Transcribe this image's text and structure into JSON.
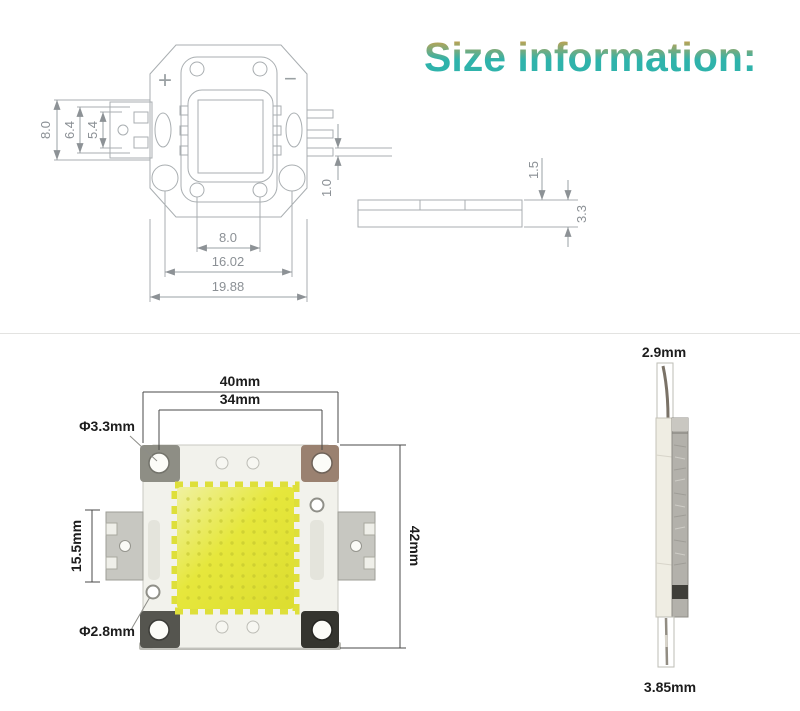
{
  "title": "Size information:",
  "top_drawing": {
    "polarity_plus": "+",
    "polarity_minus": "−",
    "dim_left_outer": "8.0",
    "dim_left_mid": "6.4",
    "dim_left_inner": "5.4",
    "dim_pin": "1.0",
    "dim_bottom_inner": "8.0",
    "dim_bottom_mid": "16.02",
    "dim_bottom_outer": "19.88",
    "side": {
      "dim_top_layer": "1.5",
      "dim_total": "3.3"
    }
  },
  "front_view": {
    "dim_width_outer": "40mm",
    "dim_hole_span": "34mm",
    "dim_corner_hole": "Φ3.3mm",
    "dim_tab_height": "15.5mm",
    "dim_side_hole": "Φ2.8mm",
    "dim_height": "42mm"
  },
  "side_view": {
    "dim_pin_top": "2.9mm",
    "dim_pin_bottom": "3.85mm"
  },
  "colors": {
    "title_teal": "#2fb3ab",
    "title_orange": "#dd9f3f",
    "phosphor_yellow": "#e4e437",
    "drawing_line": "#9aa0a4"
  }
}
